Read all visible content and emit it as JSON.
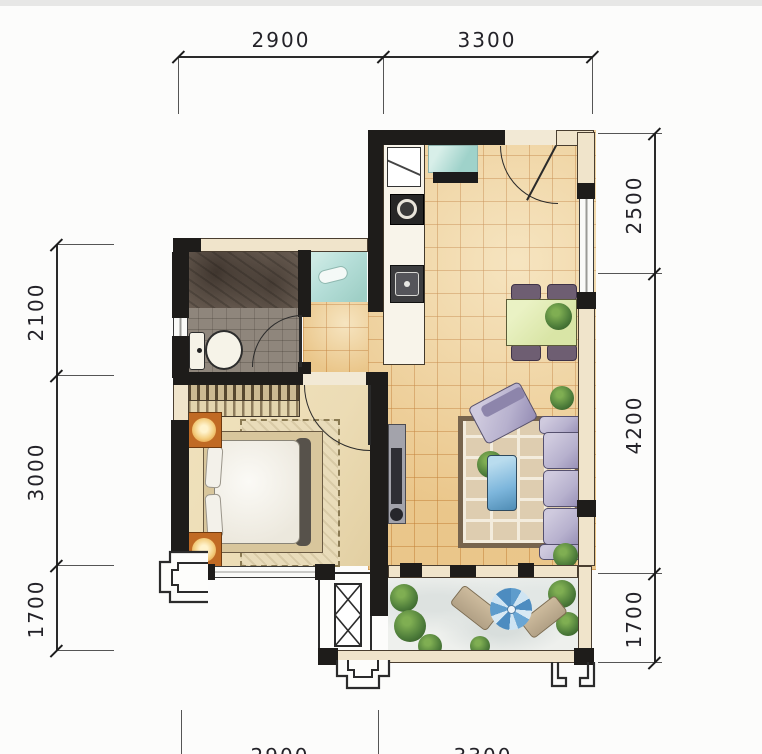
{
  "title": "one-bedroom-apartment-floor-plan",
  "dimensions": {
    "top": [
      "2900",
      "3300"
    ],
    "left": [
      "2100",
      "3000",
      "1700"
    ],
    "right": [
      "2500",
      "4200",
      "1700"
    ],
    "bottom": [
      "2900",
      "3300"
    ]
  },
  "colors": {
    "wall": "#1e1c1a",
    "wall_outline": "#4a3e30",
    "beige_wall": "#f0e4cb",
    "line": "#2a2a2a",
    "dim_text": "#232228",
    "tile": "#f2d9a5",
    "bedroom_floor": "#ecdcb5",
    "bath_dark": "#6e6156",
    "bath_light": "#8f867c",
    "teal": "#b5ded8",
    "balcony": "#eef0ed",
    "counter": "#f8f4ea",
    "orange": "#c06a24",
    "lamp": "#f4cf82",
    "sofa": "#b7b1ce",
    "sofa_outline": "#55506e",
    "chair": "#6e5e72",
    "table_green": "#d9e5a6",
    "coffee_blue": "#7db6dc",
    "plant": "#4d7c3a",
    "rug_border": "#77644d",
    "rug_fill": "#decdb0"
  }
}
